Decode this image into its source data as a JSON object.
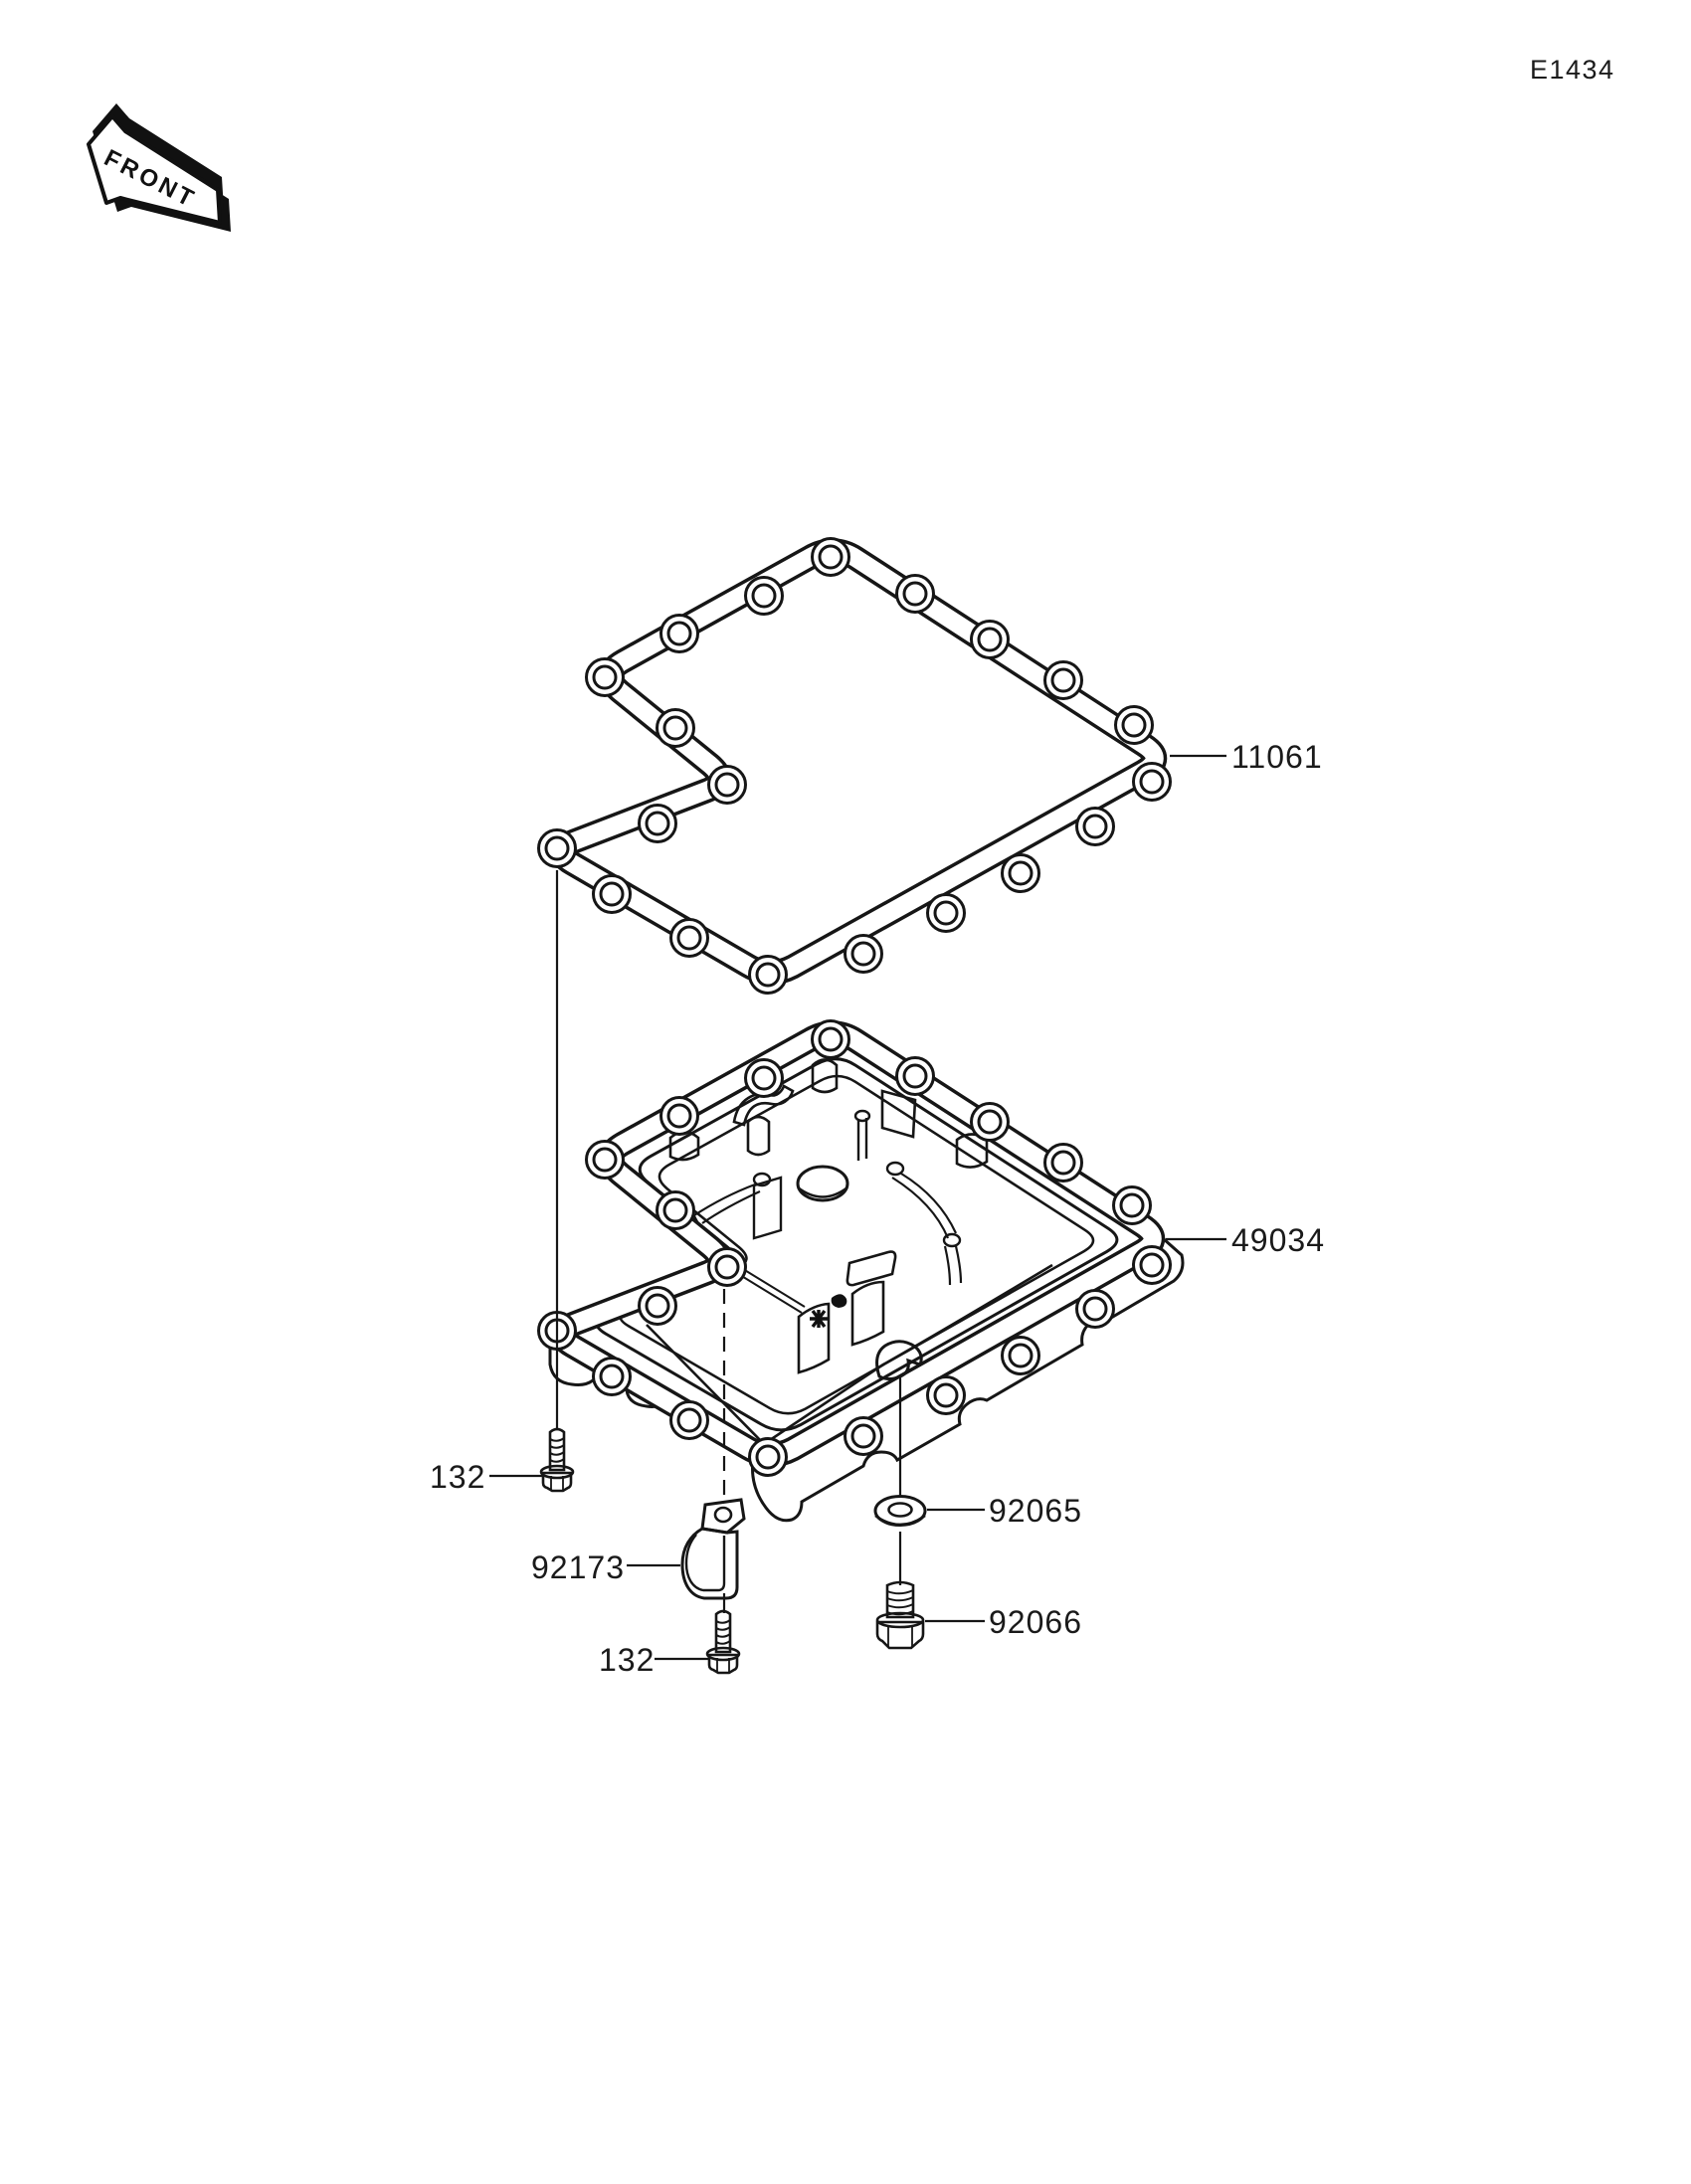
{
  "diagram": {
    "code": "E1434",
    "front_label": "FRONT",
    "callouts": {
      "gasket": "11061",
      "oil_pan": "49034",
      "washer": "92065",
      "drain_plug": "92066",
      "clamp": "92173",
      "bolt_upper": "132",
      "bolt_lower": "132"
    },
    "colors": {
      "line": "#161616",
      "background": "#ffffff"
    }
  }
}
